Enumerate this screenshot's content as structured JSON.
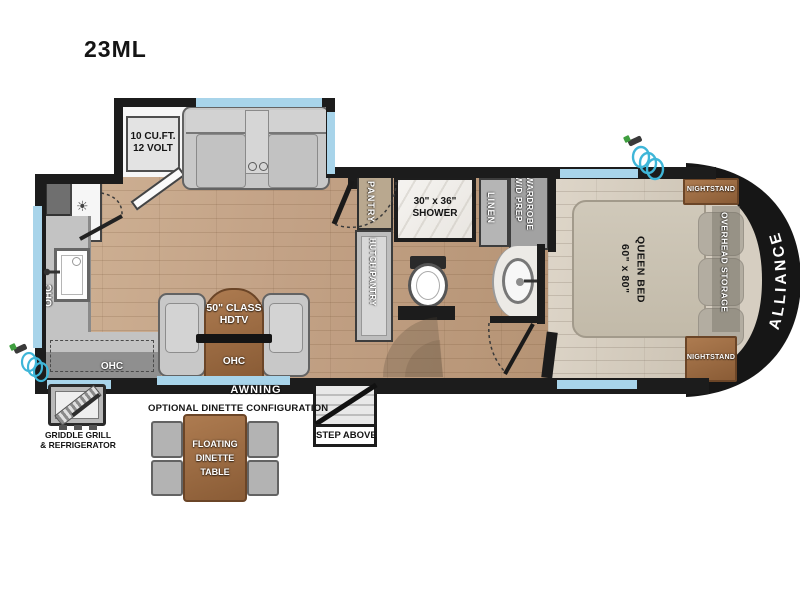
{
  "title": "23ML",
  "colors": {
    "wall": "#1c1c1c",
    "window": "#a8d4ea",
    "floor_main": "#c3a286",
    "floor_bedroom": "#d6cec1",
    "wood_furniture": "#a5744a",
    "cabinet_gray": "#bdbdbd",
    "hose_teal": "#3fb6d8",
    "front_cap": "#161616"
  },
  "floorplan": {
    "slideout": {
      "fridge_line1": "10 CU.FT.",
      "fridge_line2": "12 VOLT"
    },
    "kitchen": {
      "ohc_left": "OHC",
      "ohc_bottom": "OHC"
    },
    "living": {
      "tv_line1": "50\" CLASS",
      "tv_line2": "HDTV",
      "ohc": "OHC"
    },
    "bath": {
      "pantry": "PANTRY",
      "hutch": "HUTCH/PANTRY",
      "shower_line1": "30\" x 36\"",
      "shower_line2": "SHOWER",
      "linen": "LINEN",
      "wardrobe_line1": "WARDROBE",
      "wardrobe_line2": "W/D PREP"
    },
    "bedroom": {
      "queen_line1": "QUEEN BED",
      "queen_line2": "60\" x 80\"",
      "nightstand_top": "NIGHTSTAND",
      "nightstand_bottom": "NIGHTSTAND",
      "overhead": "OVERHEAD STORAGE",
      "brand": "ALLIANCE"
    },
    "exterior": {
      "awning": "AWNING",
      "step": "STEP ABOVE",
      "griddle_line1": "GRIDDLE GRILL",
      "griddle_line2": "& REFRIGERATOR"
    },
    "dinette": {
      "heading": "OPTIONAL DINETTE CONFIGURATION",
      "table_line1": "FLOATING",
      "table_line2": "DINETTE",
      "table_line3": "TABLE"
    }
  }
}
